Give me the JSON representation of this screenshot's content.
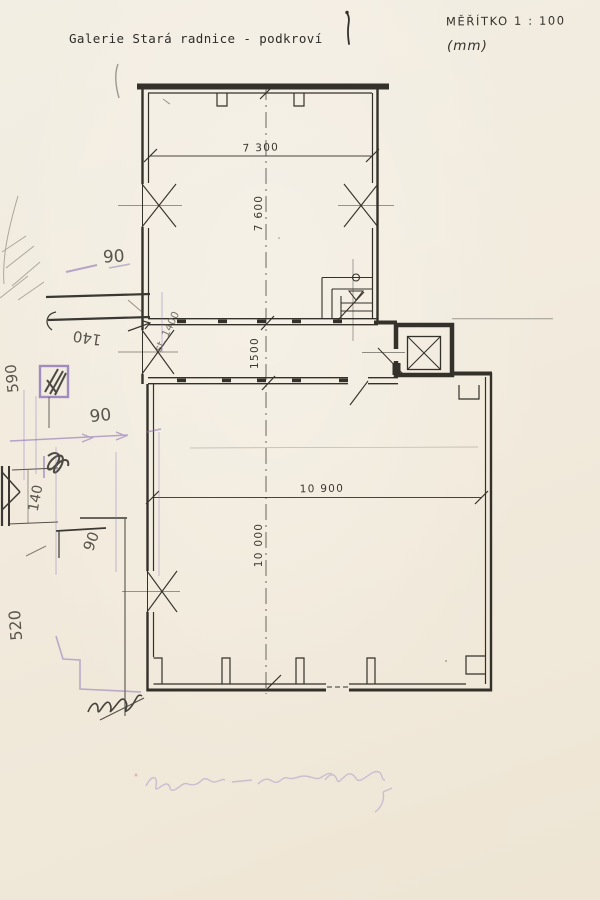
{
  "document": {
    "title": "Galerie Stará radnice - podkroví",
    "scale_label": "MĚŘÍTKO 1 : 100",
    "units_label": "(mm)"
  },
  "plan": {
    "dimensions": {
      "upper_room_width": "7 300",
      "upper_room_depth": "7 600",
      "corridor_depth": "1500",
      "lower_room_width": "10 900",
      "lower_room_depth": "10 000"
    }
  },
  "annotations": {
    "n90_upper": "90",
    "n140_upper": "140",
    "n590": "590",
    "n90_middle": "90",
    "n140_lower": "140",
    "n90_lower": "90",
    "n520": "520",
    "diag_note": "st. 1400"
  },
  "colors": {
    "ink": "#34312a",
    "pencil": "#4e4a41",
    "purple": "#8d74b6",
    "paper": "#f1ebde"
  }
}
